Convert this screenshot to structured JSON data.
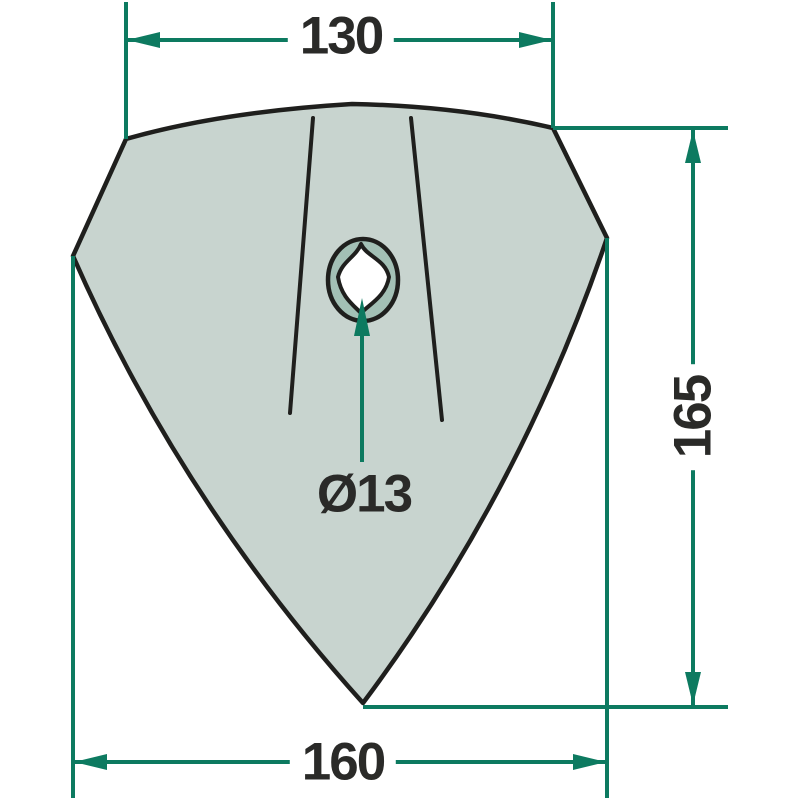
{
  "colors": {
    "accent": "#0d7a60",
    "part_fill": "#c8d4cf",
    "ring_fill": "#a3c0b5",
    "outline": "#1f1f1d",
    "ink": "#2a2a28"
  },
  "dimensions": {
    "top_width": "130",
    "right_height": "165",
    "bottom_width": "160",
    "hole_diameter": "Ø13"
  }
}
